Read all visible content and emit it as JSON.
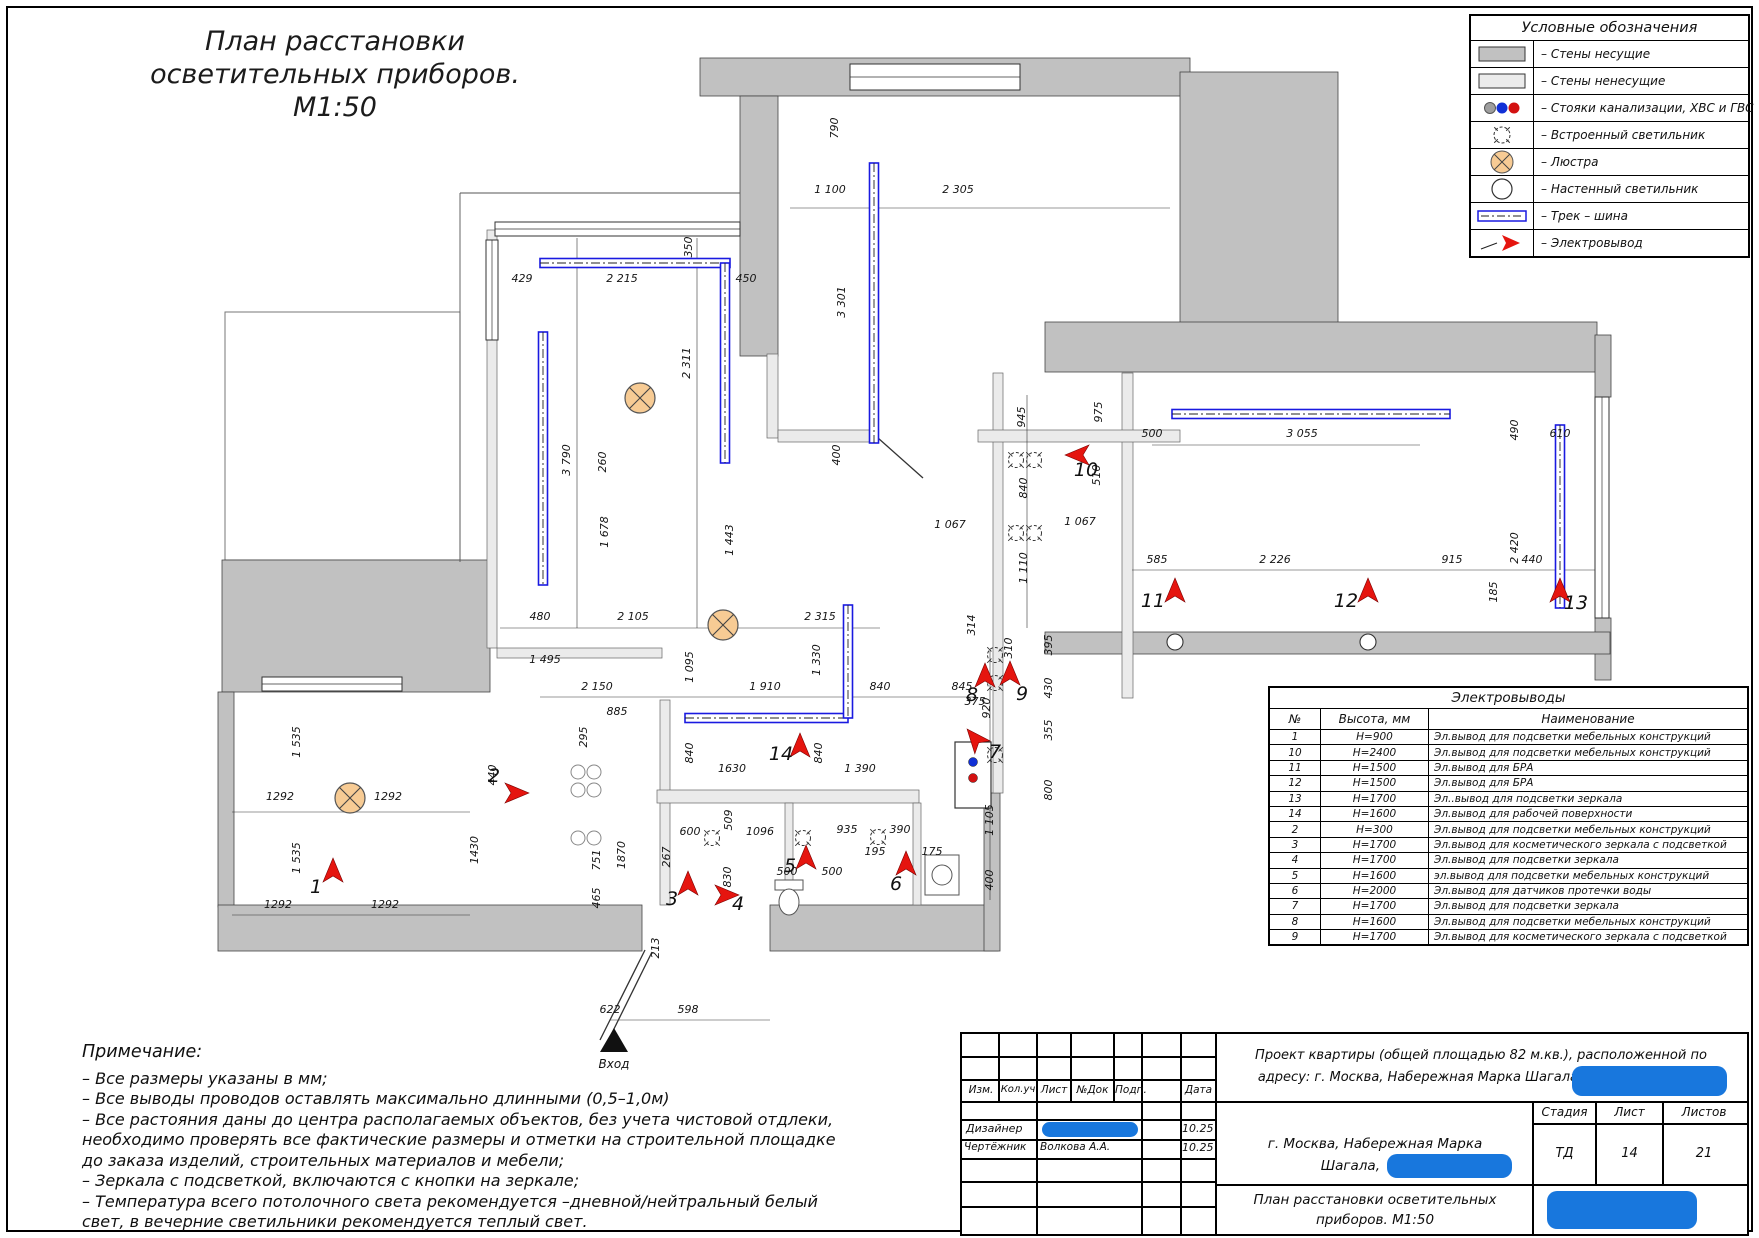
{
  "page": {
    "title_line1": "План расстановки",
    "title_line2": "осветительных приборов.",
    "title_line3": "М1:50",
    "entry_label": "Вход"
  },
  "legend": {
    "title": "Условные обозначения",
    "rows": [
      {
        "sym": "wall-bearing",
        "label": "– Стены несущие"
      },
      {
        "sym": "wall-nonbearing",
        "label": "– Стены ненесущие"
      },
      {
        "sym": "risers",
        "label": "– Стояки канализации, ХВС и ГВС"
      },
      {
        "sym": "recessed",
        "label": "– Встроенный светильник"
      },
      {
        "sym": "chandelier",
        "label": "– Люстра"
      },
      {
        "sym": "wall-lamp",
        "label": "– Настенный светильник"
      },
      {
        "sym": "track",
        "label": "– Трек – шина"
      },
      {
        "sym": "outlet",
        "label": "– Электровывод"
      }
    ]
  },
  "outlets_table": {
    "title": "Электровыводы",
    "col_no": "№",
    "col_h": "Высота, мм",
    "col_name": "Наименование",
    "rows": [
      {
        "no": "1",
        "h": "H=900",
        "name": "Эл.вывод для подсветки мебельных конструкций"
      },
      {
        "no": "10",
        "h": "H=2400",
        "name": "Эл.вывод для подсветки мебельных конструкций"
      },
      {
        "no": "11",
        "h": "H=1500",
        "name": "Эл.вывод для БРА"
      },
      {
        "no": "12",
        "h": "H=1500",
        "name": "Эл.вывод для БРА"
      },
      {
        "no": "13",
        "h": "H=1700",
        "name": "Эл..вывод для подсветки зеркала"
      },
      {
        "no": "14",
        "h": "H=1600",
        "name": "Эл.вывод для рабочей поверхности"
      },
      {
        "no": "2",
        "h": "H=300",
        "name": "Эл.вывод для подсветки мебельных конструкций"
      },
      {
        "no": "3",
        "h": "H=1700",
        "name": "Эл.вывод для косметического зеркала с подсветкой"
      },
      {
        "no": "4",
        "h": "H=1700",
        "name": "Эл.вывод для подсветки зеркала"
      },
      {
        "no": "5",
        "h": "H=1600",
        "name": "эл.вывод для подсветки мебельных конструкций"
      },
      {
        "no": "6",
        "h": "H=2000",
        "name": "Эл.вывод для датчиков протечки воды"
      },
      {
        "no": "7",
        "h": "H=1700",
        "name": "Эл.вывод для подсветки зеркала"
      },
      {
        "no": "8",
        "h": "H=1600",
        "name": "Эл.вывод для подсветки мебельных конструкций"
      },
      {
        "no": "9",
        "h": "H=1700",
        "name": "Эл.вывод для косметического зеркала с подсветкой"
      }
    ]
  },
  "notes": {
    "title": "Примечание:",
    "lines": [
      "– Все размеры указаны в мм;",
      "– Все выводы проводов оставлять максимально длинными (0,5–1,0м)",
      "– Все растояния даны до центра располагаемых объектов, без учета чистовой отдлеки,",
      "необходимо проверять все фактические размеры и отметки на строительной площадке",
      "до заказа изделий, строительных материалов и мебели;",
      "– Зеркала с подсветкой, включаются с кнопки на зеркале;",
      "– Температура всего потолочного света рекомендуется –дневной/нейтральный белый",
      "свет, в вечерние светильники рекомендуется теплый свет."
    ]
  },
  "titleblock": {
    "cols": [
      "Изм.",
      "Кол.уч",
      "Лист",
      "№Док",
      "Подп.",
      "Дата"
    ],
    "designer_role": "Дизайнер",
    "designer_date": "10.25",
    "draftsman_role": "Чертёжник",
    "draftsman_name": "Волкова А.А.",
    "draftsman_date": "10.25",
    "project_line1": "Проект квартиры (общей площадью 82 м.кв.), расположенной по",
    "project_line2": "адресу: г. Москва, Набережная Марка Шагала,",
    "address_line1": "г. Москва, Набережная Марка",
    "address_line2": "Шагала,",
    "stage_label": "Стадия",
    "sheet_label": "Лист",
    "sheets_label": "Листов",
    "stage": "ТД",
    "sheet": "14",
    "sheets": "21",
    "doc_line1": "План расстановки осветительных",
    "doc_line2": "приборов. М1:50"
  },
  "colors": {
    "bearing": "#c1c1c1",
    "light": "#ebebeb",
    "track": "#1a1ae0",
    "arrow": "#e5150f",
    "chandelier": "#f7cb94",
    "blob": "#1877dd",
    "riser_gray": "#9e9e9e",
    "riser_blue": "#1130d6",
    "riser_red": "#d31111"
  },
  "plan": {
    "walls_bearing": [
      [
        700,
        58,
        490,
        38
      ],
      [
        740,
        96,
        38,
        260
      ],
      [
        1180,
        72,
        158,
        262
      ],
      [
        1045,
        322,
        552,
        50
      ],
      [
        1595,
        335,
        16,
        62
      ],
      [
        1595,
        618,
        16,
        62
      ],
      [
        1045,
        632,
        565,
        22
      ],
      [
        222,
        560,
        268,
        132
      ],
      [
        218,
        692,
        16,
        215
      ],
      [
        218,
        905,
        424,
        46
      ],
      [
        770,
        905,
        228,
        46
      ],
      [
        984,
        793,
        16,
        158
      ]
    ],
    "walls_light": [
      [
        487,
        230,
        10,
        418
      ],
      [
        497,
        648,
        165,
        10
      ],
      [
        660,
        700,
        10,
        205
      ],
      [
        657,
        790,
        262,
        13
      ],
      [
        785,
        803,
        8,
        102
      ],
      [
        913,
        803,
        8,
        102
      ],
      [
        993,
        373,
        10,
        420
      ],
      [
        1122,
        373,
        11,
        325
      ],
      [
        767,
        354,
        11,
        84
      ],
      [
        778,
        430,
        100,
        12
      ],
      [
        978,
        430,
        202,
        12
      ]
    ],
    "thin_rects": [
      [
        225,
        312,
        235,
        248
      ],
      [
        1196,
        88,
        126,
        150
      ]
    ],
    "windows": [
      [
        495,
        222,
        245,
        14,
        "h"
      ],
      [
        850,
        64,
        170,
        26,
        "h"
      ],
      [
        486,
        240,
        12,
        100,
        "v"
      ],
      [
        262,
        677,
        140,
        14,
        "h"
      ],
      [
        1595,
        397,
        14,
        221,
        "v"
      ]
    ],
    "lines": [
      [
        460,
        193,
        740,
        193
      ],
      [
        460,
        193,
        460,
        562
      ]
    ],
    "doors": [
      [
        645,
        950,
        600,
        1040
      ],
      [
        652,
        952,
        607,
        1043
      ],
      [
        878,
        438,
        923,
        478
      ]
    ],
    "dimlines": [
      [
        500,
        628,
        880,
        628
      ],
      [
        232,
        812,
        470,
        812
      ],
      [
        232,
        915,
        470,
        915
      ],
      [
        610,
        1020,
        770,
        1020
      ],
      [
        1132,
        570,
        1595,
        570
      ],
      [
        1152,
        445,
        1420,
        445
      ],
      [
        540,
        697,
        975,
        697
      ],
      [
        697,
        238,
        697,
        628
      ],
      [
        577,
        238,
        577,
        628
      ],
      [
        1027,
        395,
        1027,
        628
      ],
      [
        990,
        650,
        990,
        900
      ],
      [
        790,
        208,
        1170,
        208
      ]
    ],
    "tracks": [
      [
        540,
        263,
        730,
        263
      ],
      [
        725,
        263,
        725,
        463
      ],
      [
        543,
        332,
        543,
        585
      ],
      [
        874,
        163,
        874,
        443
      ],
      [
        1172,
        414,
        1450,
        414
      ],
      [
        1560,
        425,
        1560,
        608
      ],
      [
        685,
        718,
        848,
        718
      ],
      [
        848,
        605,
        848,
        718
      ]
    ],
    "chandeliers": [
      [
        640,
        398
      ],
      [
        723,
        625
      ],
      [
        350,
        798
      ]
    ],
    "spots": [
      [
        1016,
        460
      ],
      [
        1034,
        460
      ],
      [
        1016,
        533
      ],
      [
        1034,
        533
      ],
      [
        712,
        838
      ],
      [
        803,
        838
      ],
      [
        878,
        837
      ],
      [
        995,
        655
      ],
      [
        995,
        683
      ],
      [
        995,
        755
      ]
    ],
    "walllamps": [
      [
        1175,
        642
      ],
      [
        1368,
        642
      ]
    ],
    "stools": [
      [
        578,
        772
      ],
      [
        594,
        772
      ],
      [
        578,
        790
      ],
      [
        594,
        790
      ],
      [
        578,
        838
      ],
      [
        594,
        838
      ]
    ],
    "toilets": [
      [
        789,
        898
      ]
    ],
    "washer": [
      925,
      855,
      34,
      40
    ],
    "cabinet": [
      955,
      742,
      36,
      66
    ],
    "risers": [
      [
        973,
        762,
        "blue"
      ],
      [
        973,
        778,
        "red"
      ]
    ],
    "arrows": [
      {
        "x": 333,
        "y": 875,
        "a": 0,
        "n": "1",
        "lx": 316,
        "ly": 893
      },
      {
        "x": 512,
        "y": 793,
        "a": 90,
        "n": "2",
        "lx": 494,
        "ly": 782
      },
      {
        "x": 688,
        "y": 888,
        "a": 0,
        "n": "3",
        "lx": 672,
        "ly": 905
      },
      {
        "x": 722,
        "y": 895,
        "a": 90,
        "n": "4",
        "lx": 738,
        "ly": 910
      },
      {
        "x": 806,
        "y": 862,
        "a": 0,
        "n": "5",
        "lx": 790,
        "ly": 872
      },
      {
        "x": 906,
        "y": 868,
        "a": 0,
        "n": "6",
        "lx": 896,
        "ly": 890
      },
      {
        "x": 978,
        "y": 742,
        "a": -40,
        "n": "7",
        "lx": 995,
        "ly": 758
      },
      {
        "x": 985,
        "y": 680,
        "a": 0,
        "n": "8",
        "lx": 972,
        "ly": 701
      },
      {
        "x": 1010,
        "y": 678,
        "a": 0,
        "n": "9",
        "lx": 1022,
        "ly": 700
      },
      {
        "x": 1082,
        "y": 455,
        "a": -90,
        "n": "10",
        "lx": 1086,
        "ly": 476
      },
      {
        "x": 1175,
        "y": 595,
        "a": 0,
        "n": "11",
        "lx": 1153,
        "ly": 607
      },
      {
        "x": 1368,
        "y": 595,
        "a": 0,
        "n": "12",
        "lx": 1346,
        "ly": 607
      },
      {
        "x": 1560,
        "y": 595,
        "a": 0,
        "n": "13",
        "lx": 1576,
        "ly": 609
      },
      {
        "x": 800,
        "y": 750,
        "a": 0,
        "n": "14",
        "lx": 781,
        "ly": 760
      }
    ],
    "dims": [
      [
        522,
        282,
        "429",
        0
      ],
      [
        622,
        282,
        "2 215",
        0
      ],
      [
        746,
        282,
        "450",
        0
      ],
      [
        692,
        247,
        "350",
        1
      ],
      [
        830,
        193,
        "1 100",
        0
      ],
      [
        958,
        193,
        "2 305",
        0
      ],
      [
        845,
        302,
        "3 301",
        1
      ],
      [
        838,
        128,
        "790",
        1
      ],
      [
        690,
        363,
        "2 311",
        1
      ],
      [
        840,
        455,
        "400",
        1
      ],
      [
        570,
        460,
        "3 790",
        1
      ],
      [
        606,
        462,
        "260",
        1
      ],
      [
        608,
        532,
        "1 678",
        1
      ],
      [
        733,
        540,
        "1 443",
        1
      ],
      [
        540,
        620,
        "480",
        0
      ],
      [
        633,
        620,
        "2 105",
        0
      ],
      [
        820,
        620,
        "2 315",
        0
      ],
      [
        693,
        667,
        "1 095",
        1
      ],
      [
        820,
        660,
        "1 330",
        1
      ],
      [
        597,
        690,
        "2 150",
        0
      ],
      [
        765,
        690,
        "1 910",
        0
      ],
      [
        880,
        690,
        "840",
        0
      ],
      [
        962,
        690,
        "845",
        0
      ],
      [
        545,
        663,
        "1 495",
        0
      ],
      [
        617,
        715,
        "885",
        0
      ],
      [
        587,
        737,
        "295",
        1
      ],
      [
        496,
        775,
        "440",
        1
      ],
      [
        693,
        753,
        "840",
        1
      ],
      [
        822,
        753,
        "840",
        1
      ],
      [
        732,
        772,
        "1630",
        0
      ],
      [
        860,
        772,
        "1 390",
        0
      ],
      [
        732,
        820,
        "509",
        1
      ],
      [
        690,
        835,
        "600",
        0
      ],
      [
        760,
        835,
        "1096",
        0
      ],
      [
        847,
        833,
        "935",
        0
      ],
      [
        900,
        833,
        "390",
        0
      ],
      [
        875,
        855,
        "195",
        0
      ],
      [
        932,
        855,
        "175",
        0
      ],
      [
        670,
        857,
        "267",
        1
      ],
      [
        731,
        877,
        "830",
        1
      ],
      [
        787,
        875,
        "500",
        0
      ],
      [
        832,
        875,
        "500",
        0
      ],
      [
        659,
        948,
        "213",
        1
      ],
      [
        610,
        1013,
        "622",
        0
      ],
      [
        688,
        1013,
        "598",
        0
      ],
      [
        280,
        800,
        "1292",
        0
      ],
      [
        388,
        800,
        "1292",
        0
      ],
      [
        278,
        908,
        "1292",
        0
      ],
      [
        385,
        908,
        "1292",
        0
      ],
      [
        300,
        742,
        "1 535",
        1
      ],
      [
        300,
        858,
        "1 535",
        1
      ],
      [
        478,
        850,
        "1430",
        1
      ],
      [
        600,
        860,
        "751",
        1
      ],
      [
        625,
        855,
        "1870",
        1
      ],
      [
        600,
        898,
        "465",
        1
      ],
      [
        990,
        708,
        "920",
        1
      ],
      [
        993,
        820,
        "1 105",
        1
      ],
      [
        993,
        880,
        "400",
        1
      ],
      [
        1025,
        417,
        "945",
        1
      ],
      [
        1102,
        412,
        "975",
        1
      ],
      [
        1027,
        488,
        "840",
        1
      ],
      [
        950,
        528,
        "1 067",
        0
      ],
      [
        1080,
        525,
        "1 067",
        0
      ],
      [
        1100,
        475,
        "510",
        1
      ],
      [
        1027,
        568,
        "1 110",
        1
      ],
      [
        1152,
        437,
        "500",
        0
      ],
      [
        1302,
        437,
        "3 055",
        0
      ],
      [
        1560,
        437,
        "610",
        0
      ],
      [
        1518,
        430,
        "490",
        1
      ],
      [
        1518,
        548,
        "2 420",
        1
      ],
      [
        1157,
        563,
        "585",
        0
      ],
      [
        1275,
        563,
        "2 226",
        0
      ],
      [
        1452,
        563,
        "915",
        0
      ],
      [
        1532,
        563,
        "440",
        0
      ],
      [
        1497,
        592,
        "185",
        1
      ],
      [
        975,
        625,
        "314",
        1
      ],
      [
        1012,
        648,
        "310",
        1
      ],
      [
        1052,
        645,
        "395",
        1
      ],
      [
        1052,
        688,
        "430",
        1
      ],
      [
        1052,
        730,
        "355",
        1
      ],
      [
        1052,
        790,
        "800",
        1
      ],
      [
        975,
        705,
        "375",
        0
      ]
    ],
    "entry": {
      "tri": [
        614,
        1028,
        600,
        1052,
        628,
        1052
      ],
      "lx": 614,
      "ly": 1068
    }
  }
}
